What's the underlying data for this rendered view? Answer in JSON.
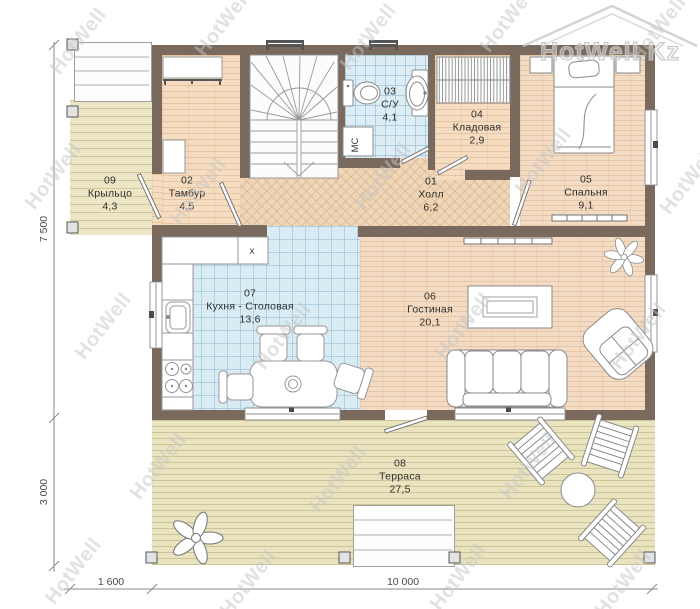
{
  "watermark": {
    "text": "HotWell",
    "logo_text": "HotWell.Kz"
  },
  "rooms": [
    {
      "id": "01",
      "name": "Холл",
      "area": "6,2"
    },
    {
      "id": "02",
      "name": "Тамбур",
      "area": "4,5"
    },
    {
      "id": "03",
      "name": "С/У",
      "area": "4,1"
    },
    {
      "id": "04",
      "name": "Кладовая",
      "area": "2,9"
    },
    {
      "id": "05",
      "name": "Спальня",
      "area": "9,1"
    },
    {
      "id": "06",
      "name": "Гостиная",
      "area": "20,1"
    },
    {
      "id": "07",
      "name": "Кухня - Столовая",
      "area": "13,6"
    },
    {
      "id": "08",
      "name": "Терраса",
      "area": "27,5"
    },
    {
      "id": "09",
      "name": "Крыльцо",
      "area": "4,3"
    }
  ],
  "dimensions": {
    "height_main": "7 500",
    "height_terrace": "3 000",
    "width_porch": "1 600",
    "width_main": "10 000"
  },
  "annotations": {
    "washing_machine": "МС",
    "kitchen_unit": "х"
  },
  "colors": {
    "wall": "#7a6a5d",
    "tile": "#dcedf5",
    "wood": "#f6ddc2",
    "herringbone": "#eed6b6",
    "deck": "#eae3bf"
  }
}
